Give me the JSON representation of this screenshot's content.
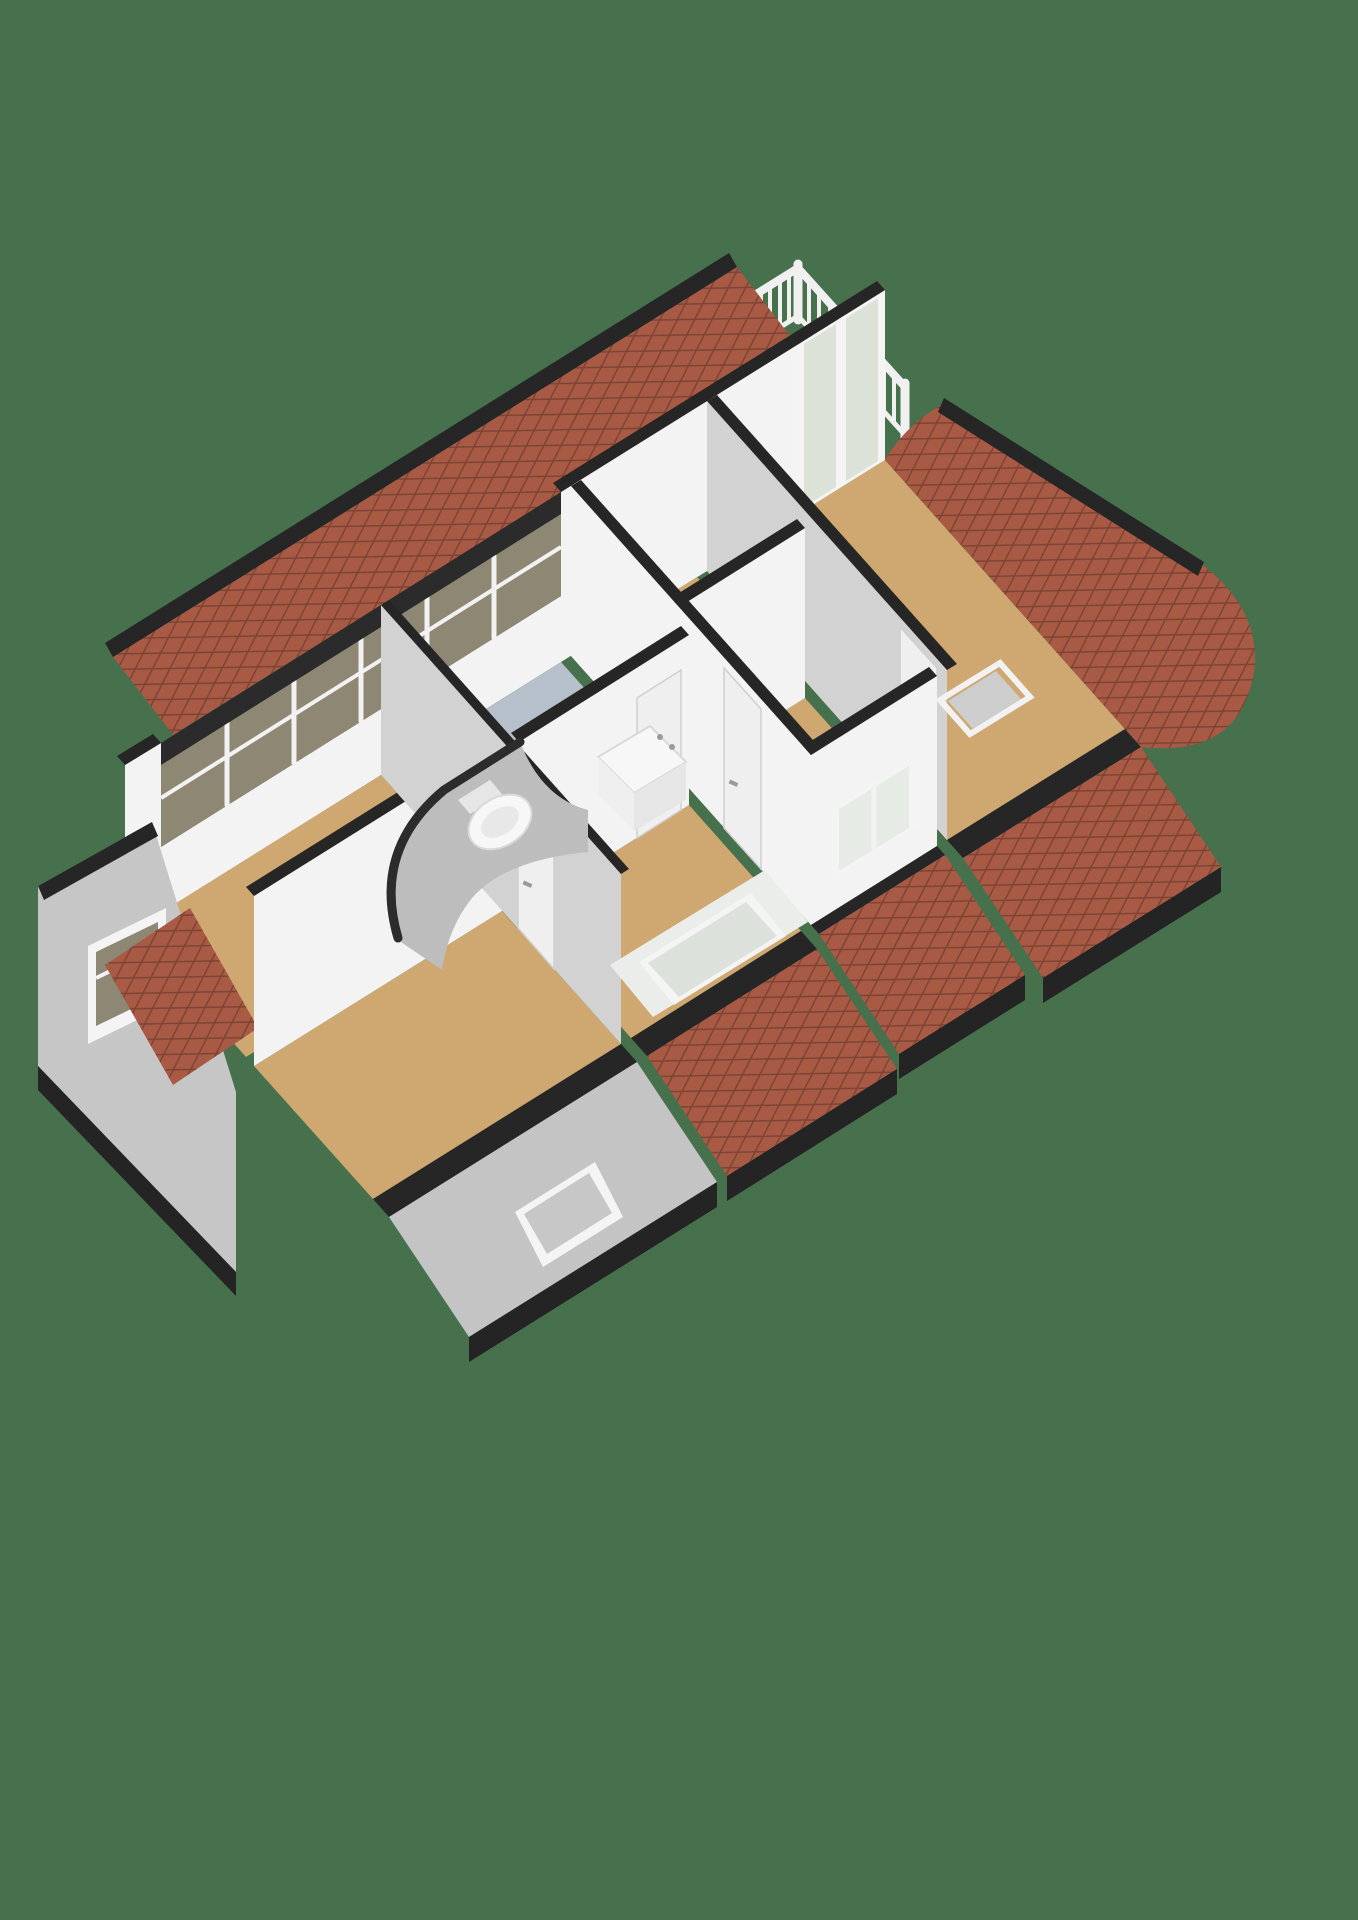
{
  "meta": {
    "content_type": "3d-floor-plan-render",
    "view": "axonometric-dollhouse",
    "visible_text": "none"
  },
  "colors": {
    "background": "#47704d",
    "floor_wood": "#cfa770",
    "floor_bathroom": "#b5c0cb",
    "floor_balcony": "#c39c63",
    "wall_white": "#f3f3f3",
    "wall_shaded": "#d2d2d2",
    "wall_exterior_gray": "#c6c6c6",
    "wall_top_cut": "#262626",
    "roof_brick": "#a85a44",
    "roof_mortar": "#7c4334",
    "glass_dormer": "#8e8773",
    "glass_door": "#dde2d8",
    "glass_window": "#e7ebe5",
    "glass_skylight": "#dde1dc",
    "skylight_gray": "#c7c7c7",
    "railing": "#f0f0f0",
    "fixture_white": "#f7f7f7",
    "hatch_gray": "#cdcdcd"
  },
  "rooms": [
    {
      "name": "bedroom-rear-left",
      "floor": "wood"
    },
    {
      "name": "bedroom-front-left",
      "floor": "wood"
    },
    {
      "name": "bathroom",
      "floor": "tile-blue-gray"
    },
    {
      "name": "landing",
      "floor": "wood"
    },
    {
      "name": "hallway",
      "floor": "wood"
    },
    {
      "name": "bedroom-middle",
      "floor": "wood"
    },
    {
      "name": "living-room-right",
      "floor": "wood"
    },
    {
      "name": "balcony",
      "floor": "wood"
    }
  ],
  "fixtures": [
    {
      "name": "toilet"
    },
    {
      "name": "washbasin-with-taps"
    },
    {
      "name": "curved-stair-wall"
    },
    {
      "name": "balcony-railing"
    },
    {
      "name": "sliding-glass-doors"
    },
    {
      "name": "dormer-window-band"
    },
    {
      "name": "gable-window"
    },
    {
      "name": "bedroom-front-window"
    },
    {
      "name": "skylight-frosted"
    },
    {
      "name": "skylight-roof"
    },
    {
      "name": "floor-hatch"
    },
    {
      "name": "interior-door",
      "count": 4
    }
  ]
}
